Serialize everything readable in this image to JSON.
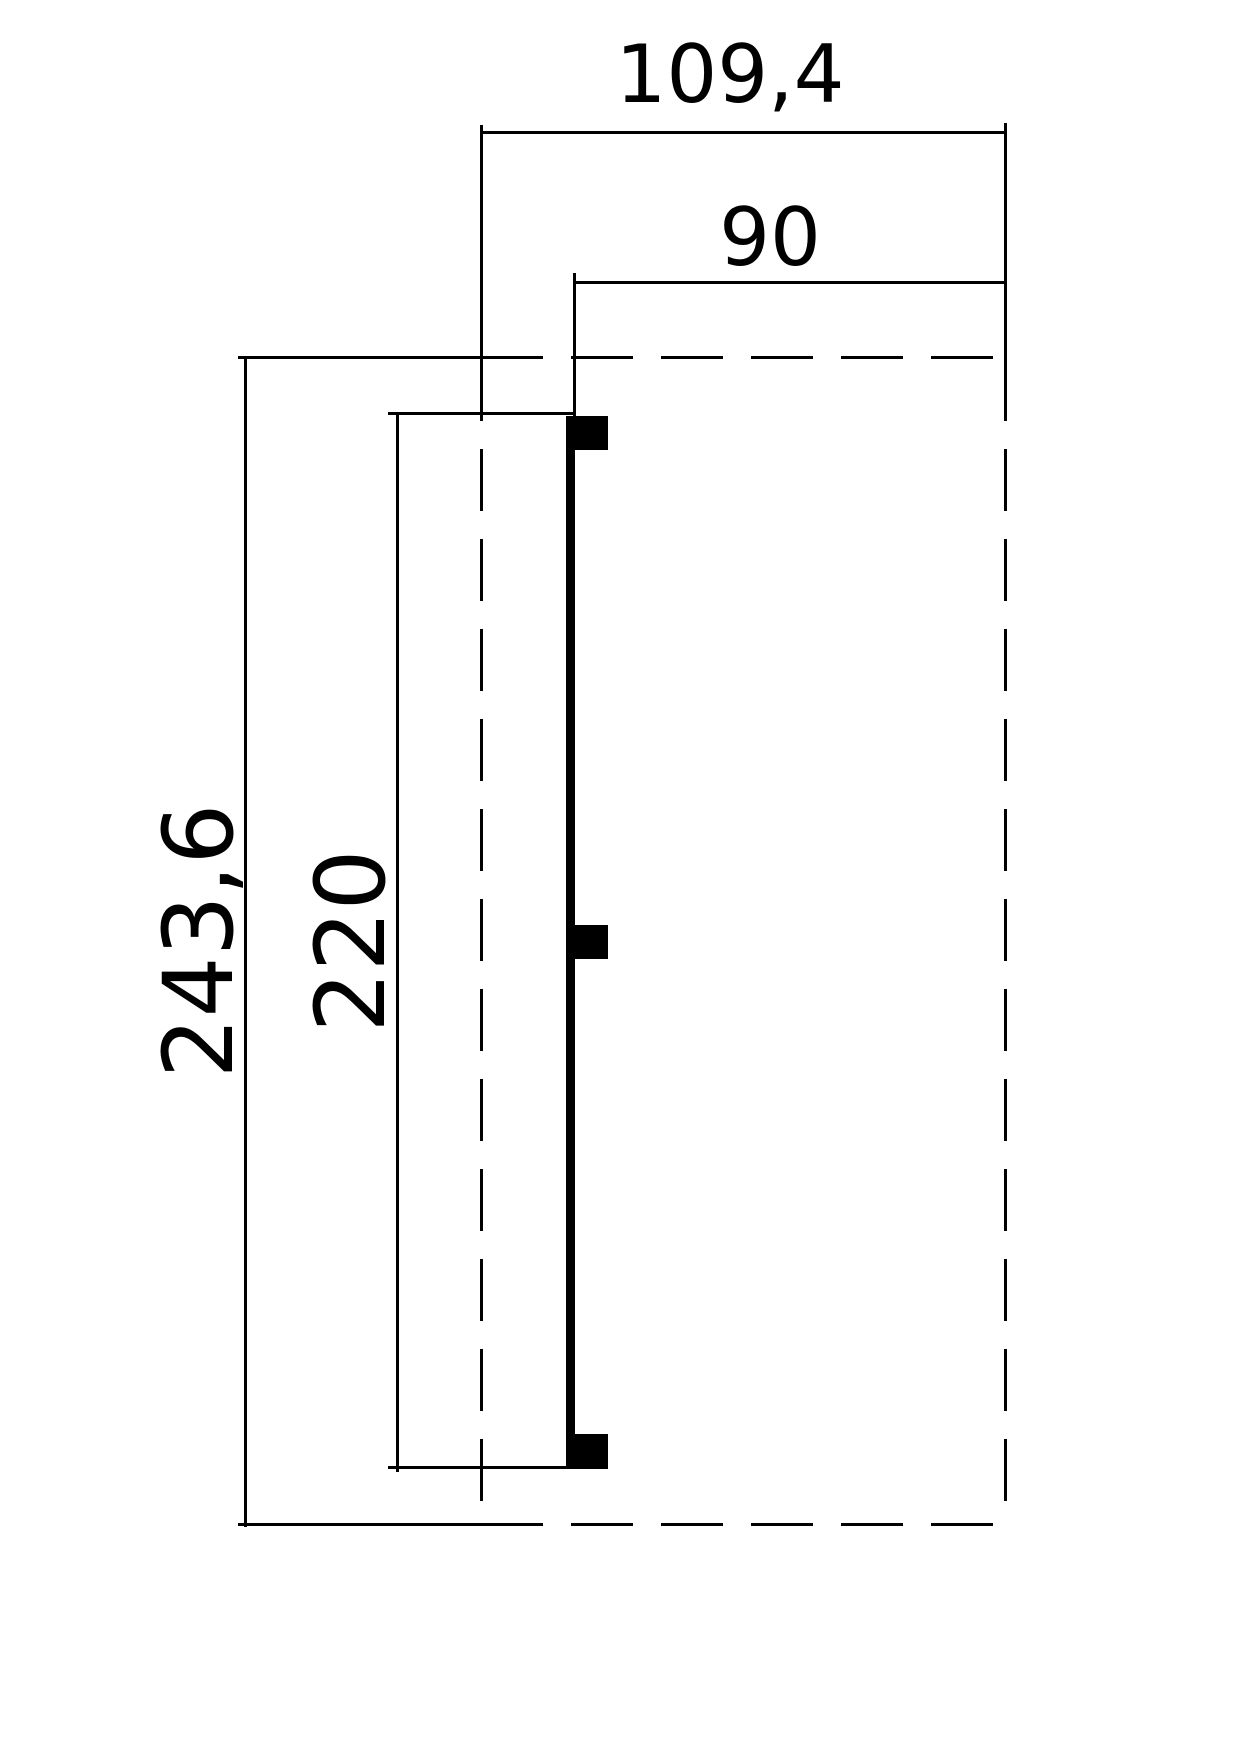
{
  "drawing": {
    "type": "technical-dimension-plan",
    "labels": {
      "total_width": "109,4",
      "inner_width": "90",
      "total_depth": "243,6",
      "inner_depth": "220"
    },
    "colors": {
      "line": "#000000",
      "background": "#ffffff"
    },
    "posts_count": 3
  }
}
